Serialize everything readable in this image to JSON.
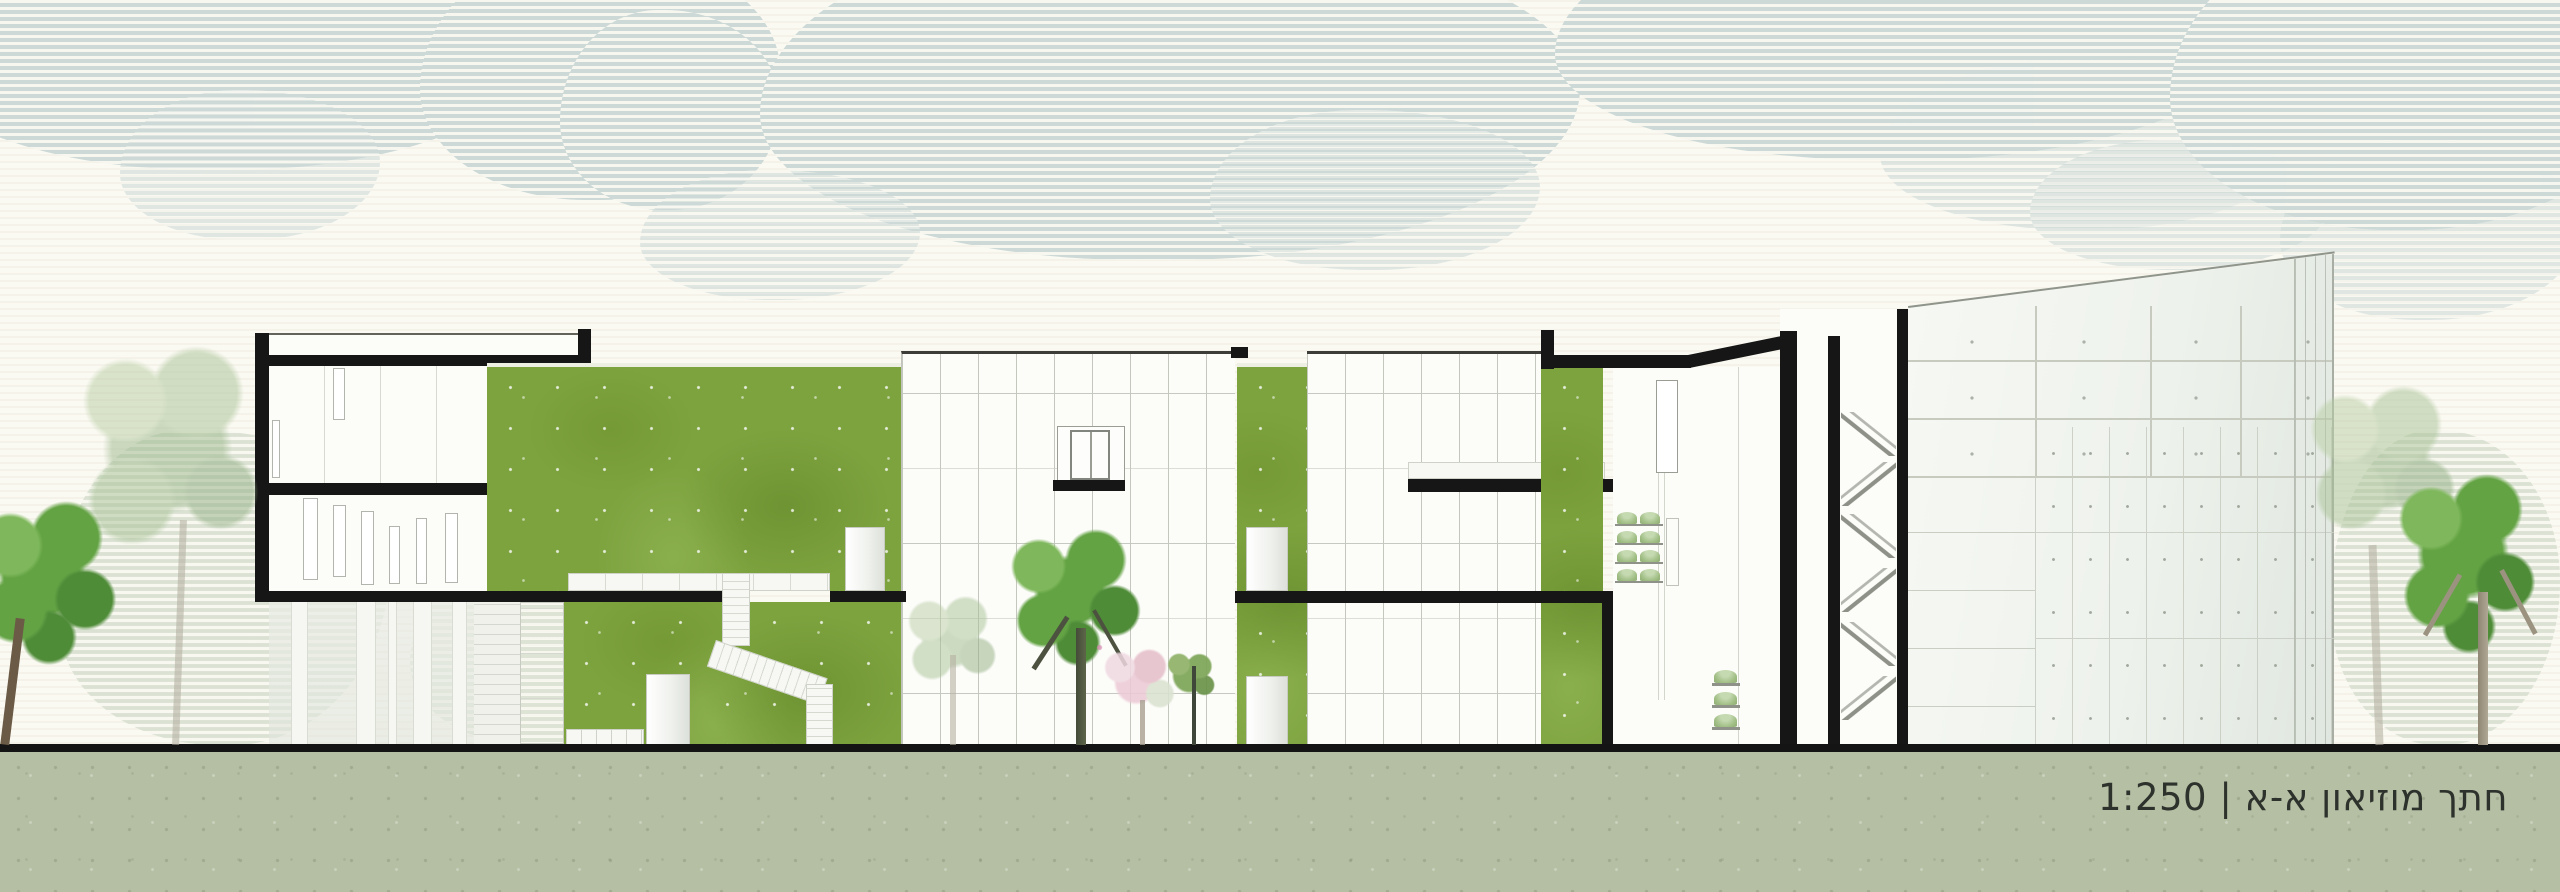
{
  "title_block": {
    "label": "חתך מוזיאון א-א | 1:250",
    "section_name": "חתך מוזיאון א-א",
    "scale": "1:250"
  },
  "drawing": {
    "type": "architectural-section-elevation",
    "subject": "museum"
  },
  "colors": {
    "sky_base": "#faf9f2",
    "halftone_blue": "#ccd9d7",
    "poche_black": "#161616",
    "facade_white": "#fcfcf9",
    "panel_line": "#c3c7bd",
    "grass_mid": "#7da33f",
    "grass_dark": "#628426",
    "grass_light": "#94b858",
    "ground_band": "#b5bfa4",
    "tree_green_dark": "#4f8c38",
    "tree_green_mid": "#63a344",
    "tree_green_light": "#7fb85c",
    "tree_faded": "#a9c396",
    "tree_pink": "#e5bdc9",
    "label_color": "#2e322c"
  }
}
